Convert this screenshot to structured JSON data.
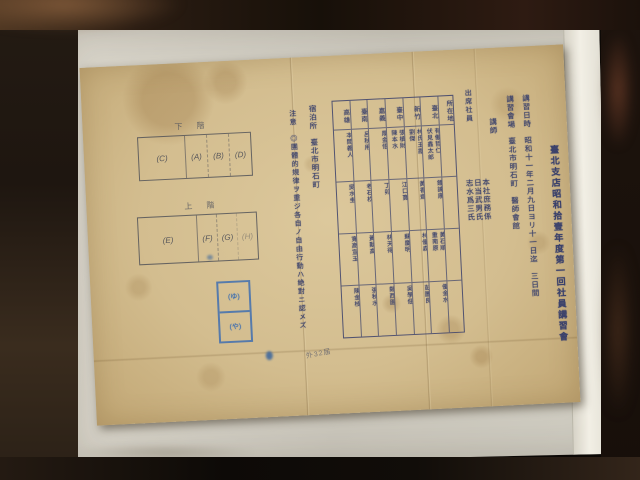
{
  "document": {
    "title": "臺北支店昭和拾壹年度第一回社員講習會",
    "schedule": {
      "label": "講習日時",
      "value": "昭和十一年二月九日ヨリ十一日迄　三日間"
    },
    "venue": {
      "label": "講習會場",
      "value": "臺北市明石町　醫師會館"
    },
    "instructor": {
      "label": "講師",
      "value": "本社庶務係\n日当武男氏\n志水爲三氏"
    },
    "attendees": {
      "label": "出席社員",
      "table": {
        "header_col": "所在地",
        "columns": [
          "臺北",
          "新竹",
          "臺中",
          "嘉義",
          "臺南",
          "高雄"
        ],
        "rows": [
          [
            "有働哲仁\n伏見鑫太郎",
            "林氏玉霞\n劉傑",
            "張槙財\n陳本水",
            "厚金悟",
            "呂秋用",
            "本間義人"
          ],
          [
            "鍾諫康",
            "黃香齋",
            "江口寶",
            "丁卯",
            "老石杦",
            "吳水圭"
          ],
          [
            "黃石順\n重南原",
            "林優森",
            "蘇慶明",
            "林天得",
            "黃勳高",
            "寬高宣玉"
          ],
          [
            "優金水",
            "彭圖良",
            "吳學佃",
            "鄭西園",
            "張秋水",
            "陳金枝"
          ]
        ]
      }
    },
    "lodging": {
      "label": "宿泊所",
      "value": "臺北市明石町"
    },
    "notes": {
      "label": "注意",
      "value": "◎團體的規律ヲ重ジ各自ノ自由行動ハ絶對ニ認メズ"
    },
    "floor_plan": {
      "lower": {
        "label": "階下",
        "cells": [
          "(C)",
          "(A)",
          "(B)",
          "(D)"
        ]
      },
      "upper": {
        "label": "階上",
        "cells": [
          "(E)",
          "(F)",
          "(G)",
          "(H)"
        ]
      }
    },
    "stamps": {
      "top": "(ゆ)",
      "bottom": "(や)"
    },
    "annotation": "外32届"
  },
  "colors": {
    "ink_blue": "#39406b",
    "stamp_blue": "#3f6fb0",
    "paper": "#d3bd8f",
    "sleeve": "#d8d4c9",
    "background": "#17100a"
  }
}
